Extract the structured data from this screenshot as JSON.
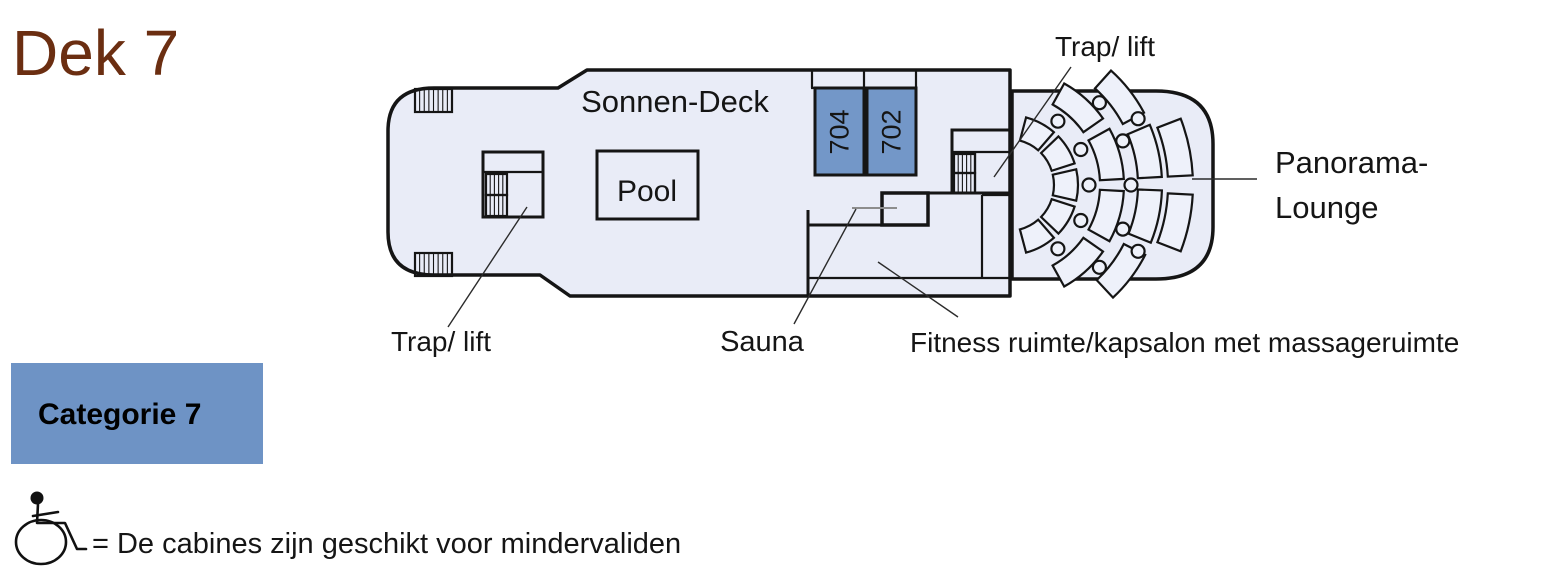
{
  "page": {
    "title": "Dek 7",
    "title_color": "#6b2e11",
    "background": "#ffffff"
  },
  "deck_plan": {
    "deck_fill": "#e9ecf7",
    "outline_color": "#151515",
    "deck_label": "Sonnen-Deck",
    "pool_label": "Pool",
    "cabin_color": "#7397c8",
    "cabins": [
      {
        "number": "704"
      },
      {
        "number": "702"
      }
    ],
    "labels": {
      "trap_lift_top": "Trap/ lift",
      "trap_lift_bottom": "Trap/ lift",
      "sauna": "Sauna",
      "fitness": "Fitness ruimte/kapsalon met massageruimte",
      "panorama_line1": "Panorama-",
      "panorama_line2": "Lounge"
    },
    "icons": {
      "stairs": "stairs-hatch-icon",
      "lounge_seating": "lounge-seating",
      "lounge_table": "lounge-table"
    }
  },
  "legend": {
    "category_badge": {
      "label": "Categorie 7",
      "color": "#6e93c5",
      "text_color": "#000000"
    },
    "accessibility": {
      "icon": "wheelchair-icon",
      "note": "= De cabines zijn geschikt voor mindervaliden"
    }
  }
}
